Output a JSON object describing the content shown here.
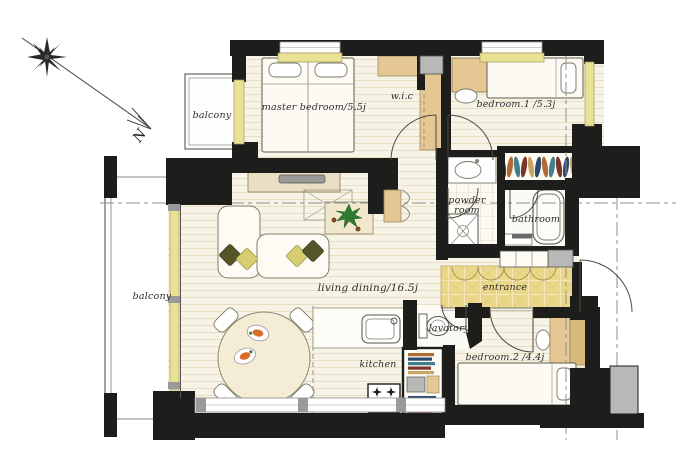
{
  "compass": {
    "north": "N"
  },
  "labels": {
    "balcony_top": "balcony",
    "balcony_left": "balcony",
    "master_bedroom": "master bedroom/5.5j",
    "wic": "w.i.c",
    "bedroom1": "bedroom.1 /5.3j",
    "powder_room_l1": "powder",
    "powder_room_l2": "room",
    "bathroom": "bathroom",
    "living_dining": "living dining/16.5j",
    "entrance": "entrance",
    "lavatory": "lavatory",
    "kitchen": "kitchen",
    "bedroom2": "bedroom.2 /4.4j"
  },
  "colors": {
    "wall": "#1d1d1b",
    "floor": "#f7f3e6",
    "cabinet_tan": "#e5c794",
    "cabinet_tan_dark": "#d9b87c",
    "window_sill": "#e9e193",
    "entrance_tile": "#ecd88c",
    "gray_fixture": "#b8b8b8",
    "cushion_light": "#d5cd6e",
    "cushion_dark": "#55552a",
    "plant": "#2f7a2f",
    "food_accent": "#d96a2a",
    "clothes_palette": [
      "#2a4a6e",
      "#b06a32",
      "#3e8090",
      "#7a3428",
      "#caa666"
    ]
  }
}
